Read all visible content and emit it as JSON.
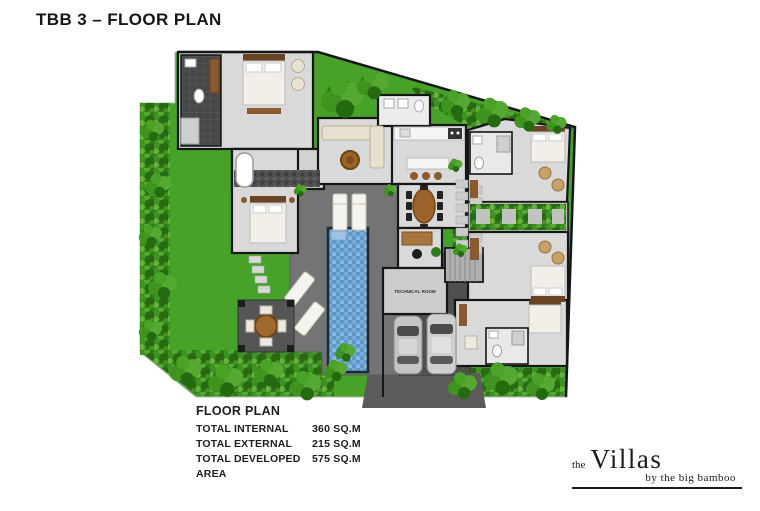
{
  "title": "TBB 3 – FLOOR PLAN",
  "plan": {
    "technical_room_label": "TECHNICAL ROOM"
  },
  "summary": {
    "heading": "FLOOR PLAN",
    "rows": [
      {
        "label": "TOTAL INTERNAL",
        "value": "360 SQ.M"
      },
      {
        "label": "TOTAL EXTERNAL",
        "value": "215 SQ.M"
      },
      {
        "label": "TOTAL DEVELOPED AREA",
        "value": "575 SQ.M"
      }
    ]
  },
  "logo": {
    "prefix": "the",
    "name": "Villas",
    "tagline": "by the big bamboo"
  },
  "colors": {
    "grass": "#47a228",
    "hedge_dark": "#2f7d17",
    "floor": "#d9d9d9",
    "wall": "#161616",
    "pool_water": "#6ba3d1",
    "deck": "#747474",
    "driveway": "#4f4f4f",
    "wood": "#9c6428",
    "text": "#1d1d1d"
  }
}
